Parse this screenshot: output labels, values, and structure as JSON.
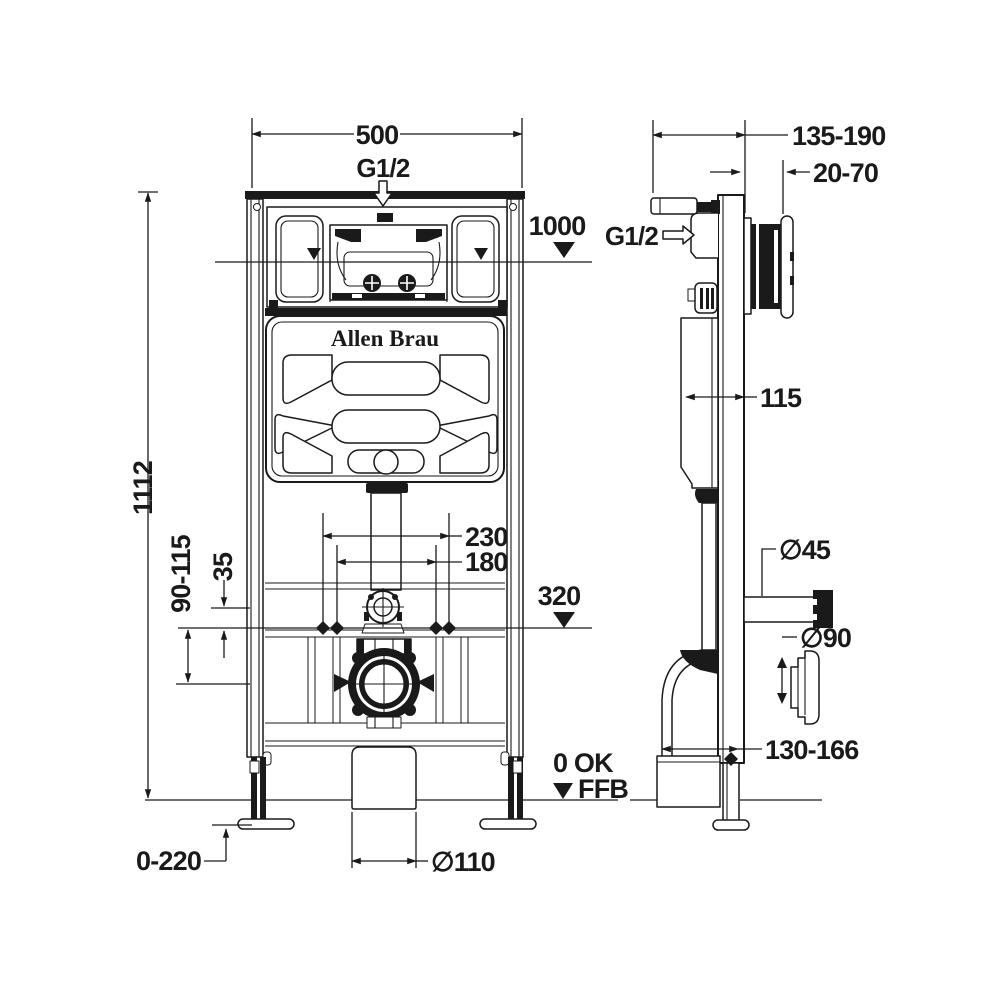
{
  "colors": {
    "ink": "#1a1a1a",
    "background": "#ffffff"
  },
  "brand": "Allen Brau",
  "front": {
    "width": "500",
    "inlet": "G1/2",
    "rim_level": "1000",
    "height": "1112",
    "fixing_width_outer": "230",
    "fixing_width_inner": "180",
    "outlet_level": "320",
    "drain_offset_range": "90-115",
    "bracket_offset": "35",
    "foot_adjust_range": "0-220",
    "floor_drain_diameter": "∅110",
    "zero_label": "0 OK",
    "floor_label": "FFB"
  },
  "side": {
    "frame_depth_range": "135-190",
    "actuator_depth_range": "20-70",
    "water_inlet": "G1/2",
    "cistern_depth": "115",
    "flush_pipe_diameter": "∅45",
    "outlet_diameter": "∅90",
    "outlet_height_range": "130-166"
  }
}
